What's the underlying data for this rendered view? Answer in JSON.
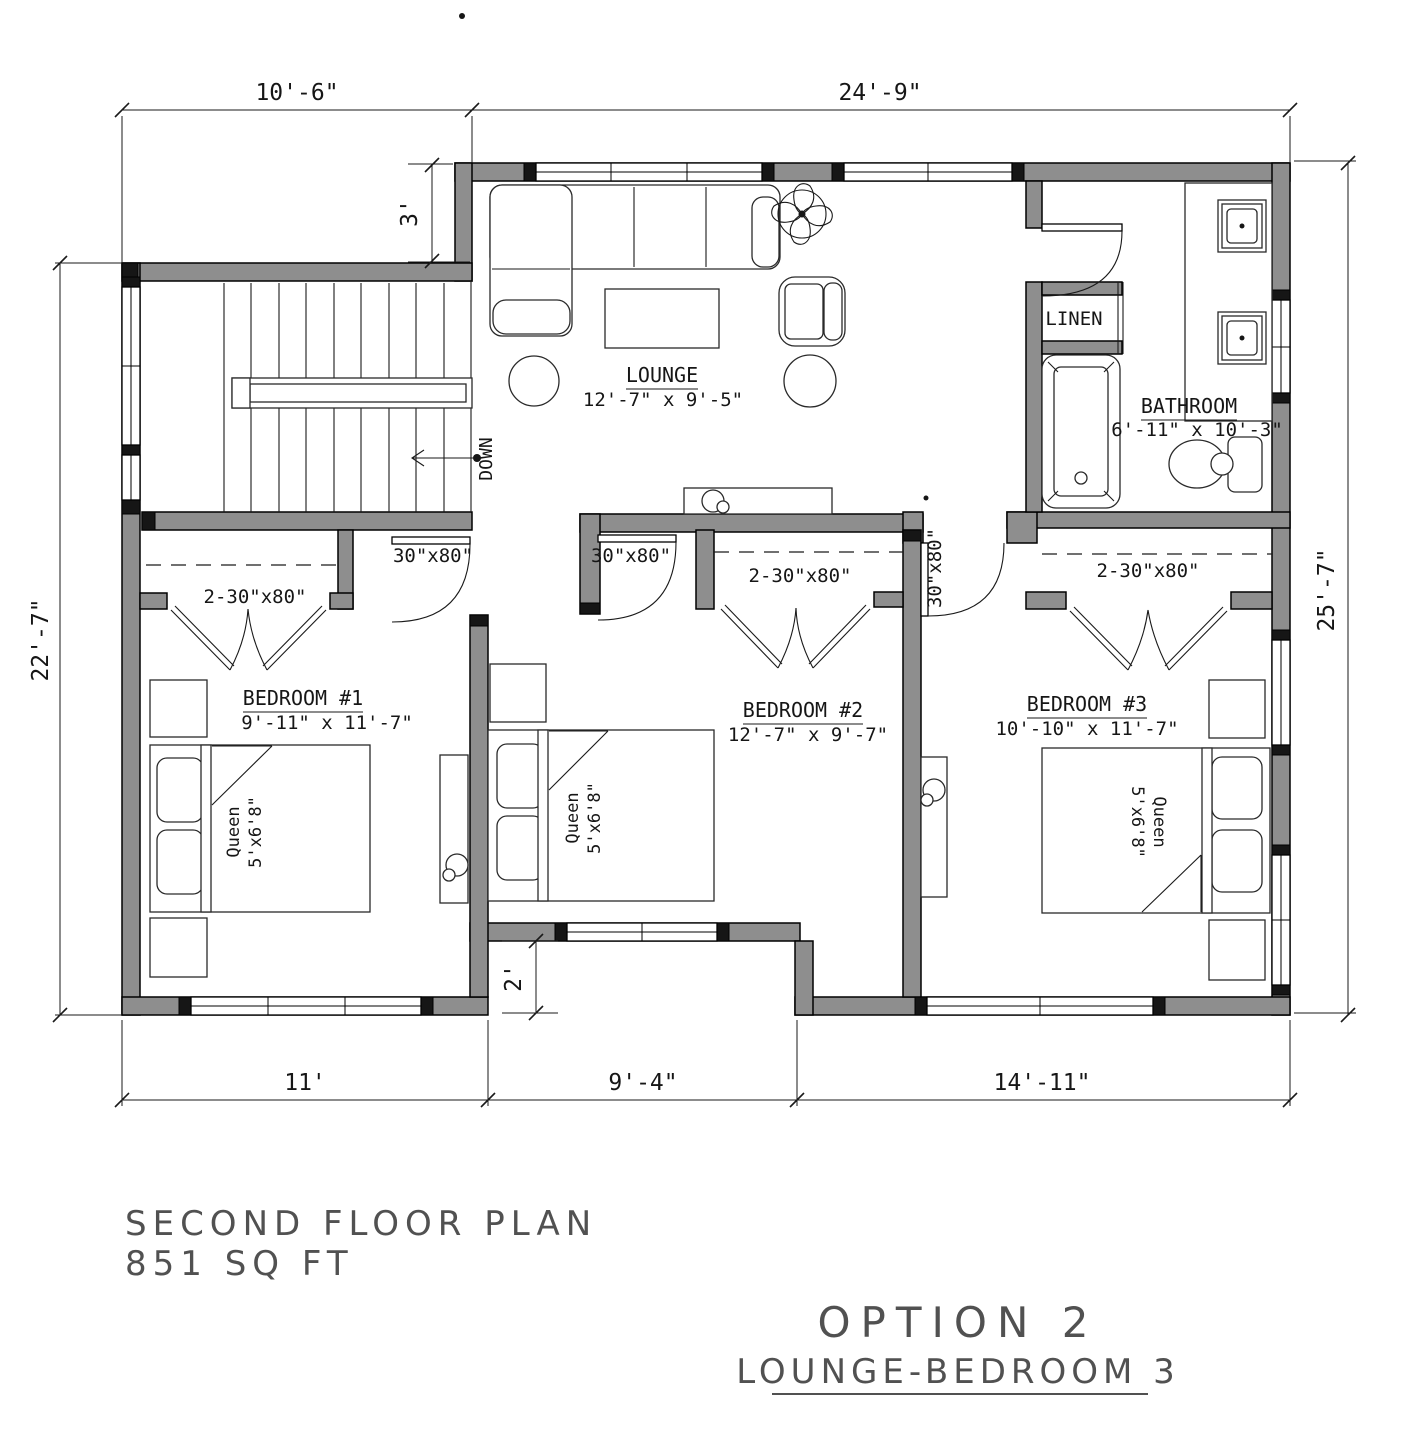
{
  "rooms": {
    "lounge": {
      "name": "LOUNGE",
      "dims": "12'-7\" x 9'-5\""
    },
    "bathroom": {
      "name": "BATHROOM",
      "dims": "6'-11\" x 10'-3\""
    },
    "linen": {
      "name": "LINEN"
    },
    "bedroom1": {
      "name": "BEDROOM #1",
      "dims": "9'-11\" x 11'-7\""
    },
    "bedroom2": {
      "name": "BEDROOM #2",
      "dims": "12'-7\" x 9'-7\""
    },
    "bedroom3": {
      "name": "BEDROOM #3",
      "dims": "10'-10\" x 11'-7\""
    }
  },
  "doors": {
    "single": "30\"x80\"",
    "double": "2-30\"x80\""
  },
  "beds": {
    "line1": "Queen",
    "line2": "5'x6'8\""
  },
  "stairs": {
    "down": "DOWN"
  },
  "dims": {
    "top_left": "10'-6\"",
    "top_right": "24'-9\"",
    "jog": "3'",
    "left": "22'-7\"",
    "right": "25'-7\"",
    "notch": "2'",
    "bottom_left": "11'",
    "bottom_mid": "9'-4\"",
    "bottom_right": "14'-11\""
  },
  "titles": {
    "plan_name": "SECOND FLOOR PLAN",
    "plan_area": "851 SQ FT",
    "option": "OPTION 2",
    "option_sub": "LOUNGE-BEDROOM 3"
  }
}
